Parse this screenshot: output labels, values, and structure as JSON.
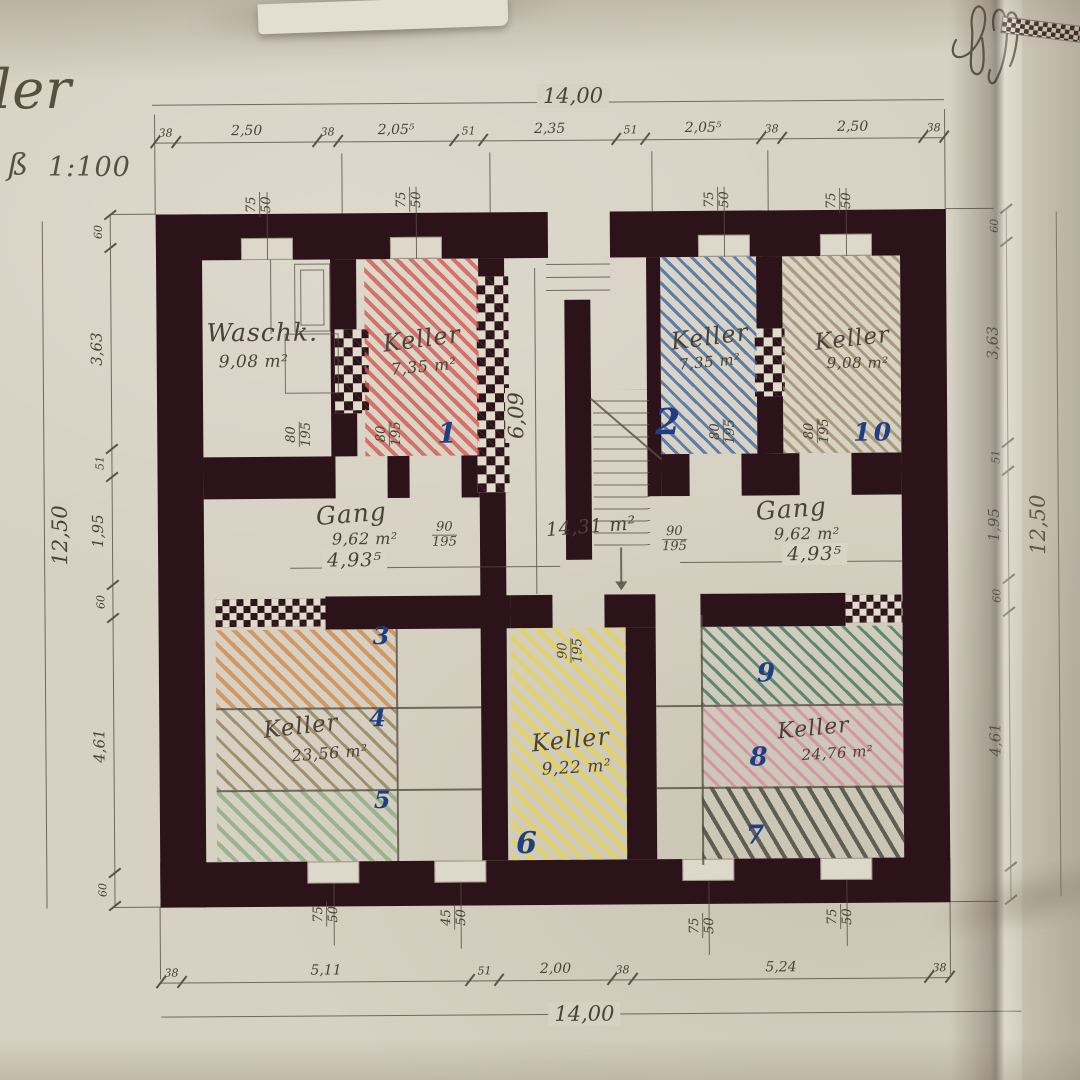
{
  "sheet": {
    "title_fragment": "ler",
    "scale_prefix": "ß",
    "scale_label": "1:100"
  },
  "rooms": {
    "waschk": {
      "name": "Waschk.",
      "area": "9,08 m²"
    },
    "keller_1": {
      "name": "Keller",
      "area": "7,35 m²",
      "number": "1"
    },
    "stair_hall": {
      "area": "14,31 m²"
    },
    "keller_2": {
      "name": "Keller",
      "area": "7,35 m²",
      "number": "2"
    },
    "keller_10": {
      "name": "Keller",
      "area": "9,08 m²",
      "number": "10"
    },
    "gang_left": {
      "name": "Gang",
      "area": "9,62 m²",
      "width": "4,93⁵"
    },
    "gang_right": {
      "name": "Gang",
      "area": "9,62 m²",
      "width": "4,93⁵"
    },
    "keller_345": {
      "name": "Keller",
      "area": "23,56 m²",
      "compartments": [
        "3",
        "4",
        "5"
      ]
    },
    "keller_6": {
      "name": "Keller",
      "area": "9,22 m²",
      "number": "6"
    },
    "keller_789": {
      "name": "Keller",
      "area": "24,76 m²",
      "compartments": [
        "9",
        "8",
        "7"
      ]
    }
  },
  "dims": {
    "top": {
      "total": "14,00",
      "segments": [
        "38",
        "2,50",
        "38",
        "2,05⁵",
        "51",
        "2,35",
        "51",
        "2,05⁵",
        "38",
        "2,50",
        "38"
      ]
    },
    "bottom": {
      "total": "14,00",
      "segments": [
        "38",
        "5,11",
        "51",
        "2,00",
        "38",
        "5,24",
        "38"
      ]
    },
    "left": {
      "total": "12,50",
      "segments": [
        "60",
        "3,63",
        "51",
        "1,95",
        "60",
        "4,61",
        "60"
      ]
    },
    "right": {
      "total": "12,50",
      "segments": [
        "60",
        "3,63",
        "51",
        "1,95",
        "60",
        "4,61"
      ]
    },
    "stair_flight_height": "6,09"
  },
  "openings": {
    "door_80": {
      "w": "80",
      "h": "195"
    },
    "door_90": {
      "w": "90",
      "h": "195"
    },
    "win_75": {
      "w": "75",
      "h": "50"
    },
    "win_45": {
      "w": "45",
      "h": "50"
    }
  },
  "colors": {
    "paper": "#d6d1c2",
    "wall": "#2b1319",
    "pencil": "#564e42",
    "ink_blue": "#1f3f85",
    "hatch_red": "#d4584e",
    "hatch_blue": "#3d68a4",
    "hatch_tan": "#9a8760",
    "hatch_orange": "#d08038",
    "hatch_sepia": "#8a744c",
    "hatch_green": "#84aa7c",
    "hatch_yellow": "#e6d44e",
    "hatch_dark_green": "#36735a",
    "hatch_pink": "#d8849e",
    "hatch_charcoal": "#43443c"
  }
}
